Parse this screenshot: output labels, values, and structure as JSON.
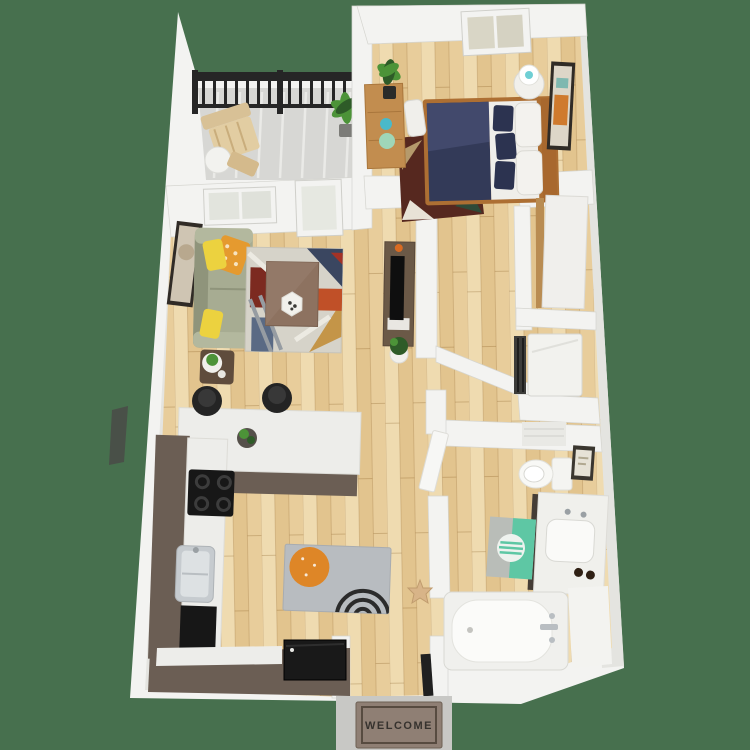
{
  "scene": {
    "description": "3D rendered aerial floor plan of a one-bedroom, one-bathroom apartment with balcony",
    "background_color": "#47704e"
  },
  "entry": {
    "welcome_mat_text": "WELCOME"
  },
  "colors": {
    "bg": "#47704e",
    "wall": "#f3f3f1",
    "wallShade": "#e4e4e0",
    "wallEdge": "#d5d5d0",
    "wood": "#e9d1a1",
    "woodLine": "#c89a5e",
    "concrete": "#d7d7d4",
    "stoop": "#c8c8c5",
    "railing": "#262626",
    "cabinet": "#6b5e54",
    "counter": "#ededea",
    "applianceBlack": "#171717",
    "steel": "#c6cbcf",
    "matGray": "#b8bcc0",
    "matOrange": "#de8627",
    "sofa": "#a7ac92",
    "sofaShade": "#8f947b",
    "pillowYellow": "#ecd23f",
    "pillowOrange": "#e59a2f",
    "rugBase": "#d6d3c9",
    "rugNavy": "#3a4660",
    "rugMaroon": "#7c2a20",
    "tableBrown": "#8d7260",
    "tvWood": "#6b5947",
    "bedNavy": "#333a58",
    "bedWhite": "#efeeea",
    "bedFrame": "#ad6f33",
    "bedRug": "#56281f",
    "furnitureWood": "#c28d4f",
    "wardrobeWhite": "#f0efec",
    "porcelain": "#f8f8f5",
    "teal": "#5ec7a4",
    "plantGreen": "#4c9338",
    "plantDark": "#2e5b28",
    "welcomeMat": "#8f7f74",
    "welcomeBorder": "#574b40",
    "welcomeText": "#36322e",
    "doorDark": "#202020",
    "frameDark": "#302b26",
    "artBeige": "#cfc5b3"
  },
  "rooms": [
    {
      "name": "balcony",
      "items": [
        "railing",
        "lounge-chair",
        "side-table",
        "potted-plant"
      ]
    },
    {
      "name": "bedroom",
      "items": [
        "bed",
        "nightstand",
        "lamp",
        "dresser",
        "plant",
        "wall-art",
        "area-rug",
        "window"
      ]
    },
    {
      "name": "living-room",
      "items": [
        "sofa",
        "throw-pillows",
        "coffee-table",
        "area-rug",
        "tv-console",
        "tv",
        "side-table",
        "wall-art",
        "window",
        "balcony-door"
      ]
    },
    {
      "name": "kitchen",
      "items": [
        "island",
        "bar-stools",
        "cooktop",
        "sink",
        "refrigerator",
        "cabinets",
        "floor-mat"
      ]
    },
    {
      "name": "walk-in-closet",
      "items": [
        "wardrobe"
      ]
    },
    {
      "name": "laundry-closet",
      "items": [
        "washer"
      ]
    },
    {
      "name": "bathroom",
      "items": [
        "toilet",
        "vanity",
        "bathtub",
        "bath-mat",
        "wall-art"
      ]
    },
    {
      "name": "entry",
      "items": [
        "door",
        "stoop",
        "welcome-mat"
      ]
    }
  ]
}
